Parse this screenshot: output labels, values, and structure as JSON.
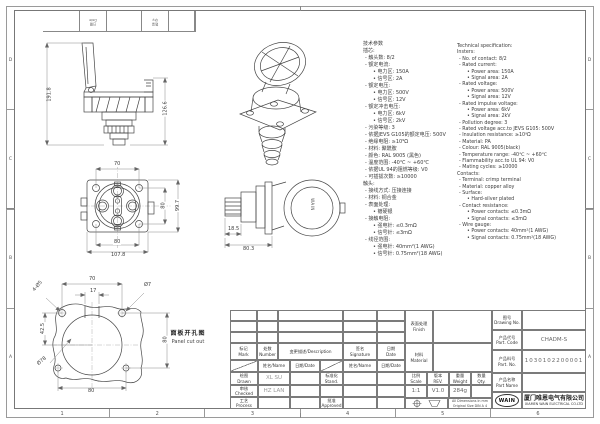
{
  "sheet": {
    "grid_numbers": [
      "1",
      "2",
      "3",
      "4",
      "5",
      "6"
    ],
    "grid_letters_left": [
      "D",
      "C",
      "B",
      "A"
    ],
    "grid_letters_right": [
      "D",
      "C",
      "B",
      "A"
    ],
    "corner_labels": {
      "cell1": "日期\nDate",
      "cell2": "数量\nQty."
    }
  },
  "drawings": {
    "side_view": {
      "dim_total_height": "191.8",
      "dim_body_height": "126.6"
    },
    "front_view": {
      "dim_hole_spacing_top": "70",
      "dim_hole_spacing_right": "80",
      "dim_flange_height": "99.7",
      "dim_hole_spacing_bottom": "80",
      "dim_flange_width": "107.8"
    },
    "rear_view": {
      "dim_pin_depth": "18.5",
      "dim_total_depth": "80.3",
      "cover_logo": "WAIN"
    },
    "panel_cutout": {
      "title_zh": "面板开孔图",
      "title_en": "Panel cut out",
      "dim_hole_spacing_top": "70",
      "dim_slot_width": "17",
      "dim_center_offset": "42.5",
      "dim_hole_spacing_right": "80",
      "dim_hole_spacing_bottom": "80",
      "label_mounting_holes": "4-Ø5",
      "label_small_hole": "Ø7",
      "label_main_hole": "Ø78"
    }
  },
  "spec_zh": {
    "lines": [
      {
        "t": "技术参数",
        "l": 0
      },
      {
        "t": "插芯:",
        "l": 0
      },
      {
        "t": "- 触头数: 8/2",
        "l": 1
      },
      {
        "t": "- 额定电流:",
        "l": 1
      },
      {
        "t": "• 电力区: 150A",
        "l": 2
      },
      {
        "t": "• 信号区: 2A",
        "l": 2
      },
      {
        "t": "- 额定电压:",
        "l": 1
      },
      {
        "t": "• 电力区: 500V",
        "l": 2
      },
      {
        "t": "• 信号区: 12V",
        "l": 2
      },
      {
        "t": "- 额定冲击电压:",
        "l": 1
      },
      {
        "t": "• 电力区: 6kV",
        "l": 2
      },
      {
        "t": "• 信号区: 2kV",
        "l": 2
      },
      {
        "t": "- 污染等级: 3",
        "l": 1
      },
      {
        "t": "- 依据JEVS G105的额定电压: 500V",
        "l": 1
      },
      {
        "t": "- 绝缘电阻: ≥10⁹Ω",
        "l": 1
      },
      {
        "t": "- 材料: 聚酰胺",
        "l": 1
      },
      {
        "t": "- 颜色: RAL 9005 (黑色)",
        "l": 1
      },
      {
        "t": "- 温度范围: -40℃ ~ +60℃",
        "l": 1
      },
      {
        "t": "- 依据UL 94的阻燃等级: V0",
        "l": 1
      },
      {
        "t": "- 可插拔次数: ≥10000",
        "l": 1
      },
      {
        "t": "触头:",
        "l": 0
      },
      {
        "t": "- 接线方式: 压接连接",
        "l": 1
      },
      {
        "t": "- 材料: 铜合金",
        "l": 1
      },
      {
        "t": "- 表面处理:",
        "l": 1
      },
      {
        "t": "• 镀硬银",
        "l": 2
      },
      {
        "t": "- 接触电阻:",
        "l": 1
      },
      {
        "t": "• 强电针: ≤0.3mΩ",
        "l": 2
      },
      {
        "t": "• 信号针: ≤3mΩ",
        "l": 2
      },
      {
        "t": "- 线径范围:",
        "l": 1
      },
      {
        "t": "• 强电针: 40mm²(1 AWG)",
        "l": 2
      },
      {
        "t": "• 信号针: 0.75mm²(18 AWG)",
        "l": 2
      }
    ]
  },
  "spec_en": {
    "lines": [
      {
        "t": "Technical specification:",
        "l": 0
      },
      {
        "t": "Insters:",
        "l": 0
      },
      {
        "t": "- No. of contact: 8/2",
        "l": 1
      },
      {
        "t": "- Rated current:",
        "l": 1
      },
      {
        "t": "• Power area: 150A",
        "l": 2
      },
      {
        "t": "• Signal area: 2A",
        "l": 2
      },
      {
        "t": "- Rated voltage:",
        "l": 1
      },
      {
        "t": "• Power area: 500V",
        "l": 2
      },
      {
        "t": "• Signal area: 12V",
        "l": 2
      },
      {
        "t": "- Rated impulse voltage:",
        "l": 1
      },
      {
        "t": "• Power area: 6kV",
        "l": 2
      },
      {
        "t": "• Signal area: 2kV",
        "l": 2
      },
      {
        "t": "- Pollution degree: 3",
        "l": 1
      },
      {
        "t": "- Rated voltage acc.to JEVS G105: 500V",
        "l": 1
      },
      {
        "t": "- Insulation resistance: ≥10⁹Ω",
        "l": 1
      },
      {
        "t": "- Material: PA",
        "l": 1
      },
      {
        "t": "- Colour: RAL 9005(black)",
        "l": 1
      },
      {
        "t": "- Temperature range: -40℃ ~ +60℃",
        "l": 1
      },
      {
        "t": "- Flammability acc.to UL 94: V0",
        "l": 1
      },
      {
        "t": "- Mating cycles: ≥10000",
        "l": 1
      },
      {
        "t": "Contacts:",
        "l": 0
      },
      {
        "t": "- Terminal: crimp terminal",
        "l": 1
      },
      {
        "t": "- Material: copper alloy",
        "l": 1
      },
      {
        "t": "- Surface:",
        "l": 1
      },
      {
        "t": "• Hard-silver plated",
        "l": 2
      },
      {
        "t": "- Contact resistance:",
        "l": 1
      },
      {
        "t": "• Power contacts: ≤0.3mΩ",
        "l": 2
      },
      {
        "t": "• Signal contacts: ≤3mΩ",
        "l": 2
      },
      {
        "t": "- Wire gauge:",
        "l": 1
      },
      {
        "t": "• Power contacts: 40mm²(1 AWG)",
        "l": 2
      },
      {
        "t": "• Signal contacts: 0.75mm²(18 AWG)",
        "l": 2
      }
    ]
  },
  "title_block": {
    "rev_header": {
      "mark": "标记\nMark",
      "number": "处数\nNumber",
      "description": "变更描述/Description",
      "signature": "签名\nSignature",
      "date": "日期\nDate"
    },
    "sub_header": {
      "name_left": "姓名/Name",
      "date_left": "日期/Date",
      "name_right": "姓名/Name",
      "date_right": "日期/Date"
    },
    "drawn_label": "绘图\nDrawn",
    "drawn_name": "XL SU",
    "checked_label": "审核\nChecked",
    "checked_name": "HZ LAN",
    "process_label": "工艺\nProcess",
    "stand_label": "标准化\nStand.",
    "approved_label": "批准\nApproved",
    "finish_label": "表面处理\nFinish",
    "material_label": "材料\nMaterial",
    "scale_label": "比例\nScale",
    "scale_value": "1:1",
    "rev_label": "版本\nREV.",
    "rev_value": "V1.0",
    "weight_label": "重量\nWeight",
    "weight_value": "284g",
    "qty_label": "数量\nQty.",
    "dims_note_line1": "All Dimensions in mm",
    "dims_note_line2": "Original Size DIN A 4",
    "drawing_no_label": "图号\nDrawing No.",
    "part_code_label": "产品代号\nPart. Code",
    "part_code_value": "CHADM-S",
    "part_no_label": "产品料号\nPart. No.",
    "part_no_value": "1030102200001",
    "part_name_label": "产品名称\nPart Name",
    "logo_text": "WAIN",
    "company_zh": "厦门唯恩电气有限公司",
    "company_en": "XIAMEN WAIN ELECTRICAL CO.LTD"
  }
}
